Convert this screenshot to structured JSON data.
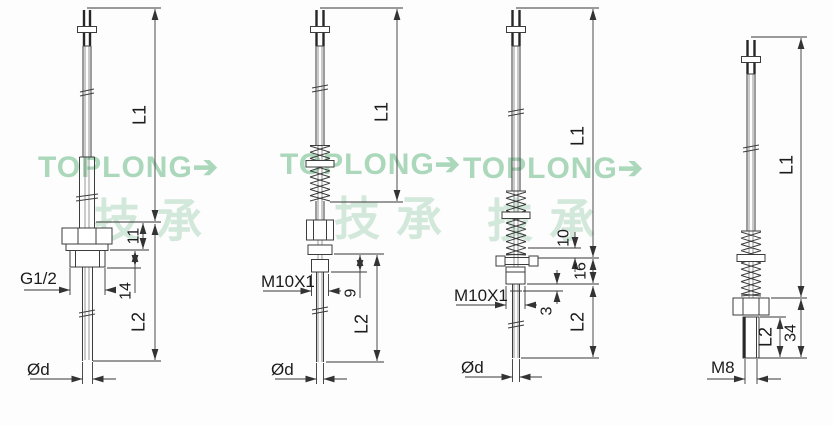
{
  "watermark": {
    "brand": "TOPLONG",
    "arrow": "➔",
    "cjk": "技承"
  },
  "figures": [
    {
      "id": "probe-g12-bushing",
      "labels": {
        "l1": "L1",
        "l2": "L2",
        "hex_height": "11",
        "thread_len": "14",
        "thread": "G1/2",
        "diameter": "Ød"
      }
    },
    {
      "id": "probe-m10-spring",
      "labels": {
        "l1": "L1",
        "l2": "L2",
        "nut_len": "9",
        "thread": "M10X1",
        "diameter": "Ød"
      }
    },
    {
      "id": "probe-m10-flange-spring",
      "labels": {
        "l1": "L1",
        "l2": "L2",
        "spring_offset": "10",
        "flange_nut": "16",
        "clip_gap": "3",
        "thread": "M10X1",
        "diameter": "Ød"
      }
    },
    {
      "id": "probe-m8-tip",
      "labels": {
        "l1": "L1",
        "l2": "L2",
        "tip_len": "34",
        "thread": "M8"
      }
    }
  ]
}
